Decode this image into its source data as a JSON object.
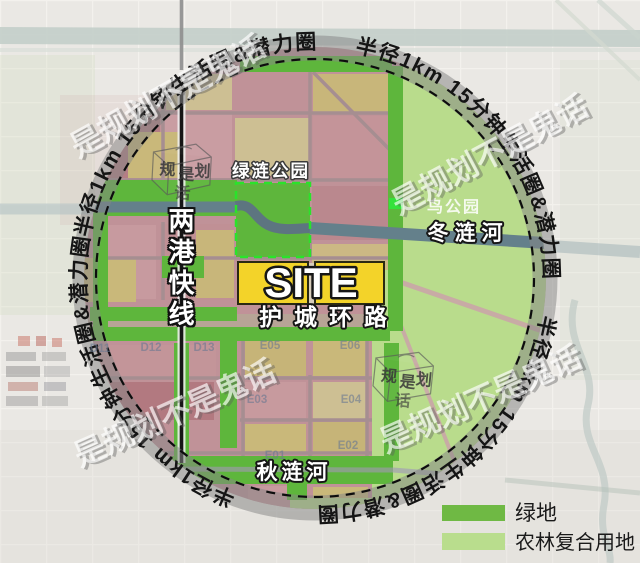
{
  "ring_label": "半径1km 15分钟生活圈&潜力圈",
  "watermark": "是规划不是鬼话",
  "site": {
    "label": "SITE"
  },
  "labels": {
    "ring_road": "护城环路",
    "express_line": "两港快线",
    "north_river": "冬涟河",
    "south_river": "秋涟河",
    "green_park": "绿涟公园",
    "bird_park": "鸟公园"
  },
  "stamp": {
    "c1": "规",
    "c2": "是",
    "c3": "划",
    "c4": "话"
  },
  "parcels": [
    "D11",
    "D12",
    "D13",
    "E05",
    "E06",
    "E03",
    "E04",
    "E01",
    "E02"
  ],
  "legend": [
    {
      "label": "绿地",
      "color": "#6fb944"
    },
    {
      "label": "农林复合用地",
      "color": "#b9dd8d"
    }
  ],
  "colors": {
    "site_fill": "#f3d329",
    "corridor_green": "#5eb63c",
    "farm_green": "#b9dc8c",
    "river": "#64808b",
    "ring_band": "#8a8a8a"
  }
}
